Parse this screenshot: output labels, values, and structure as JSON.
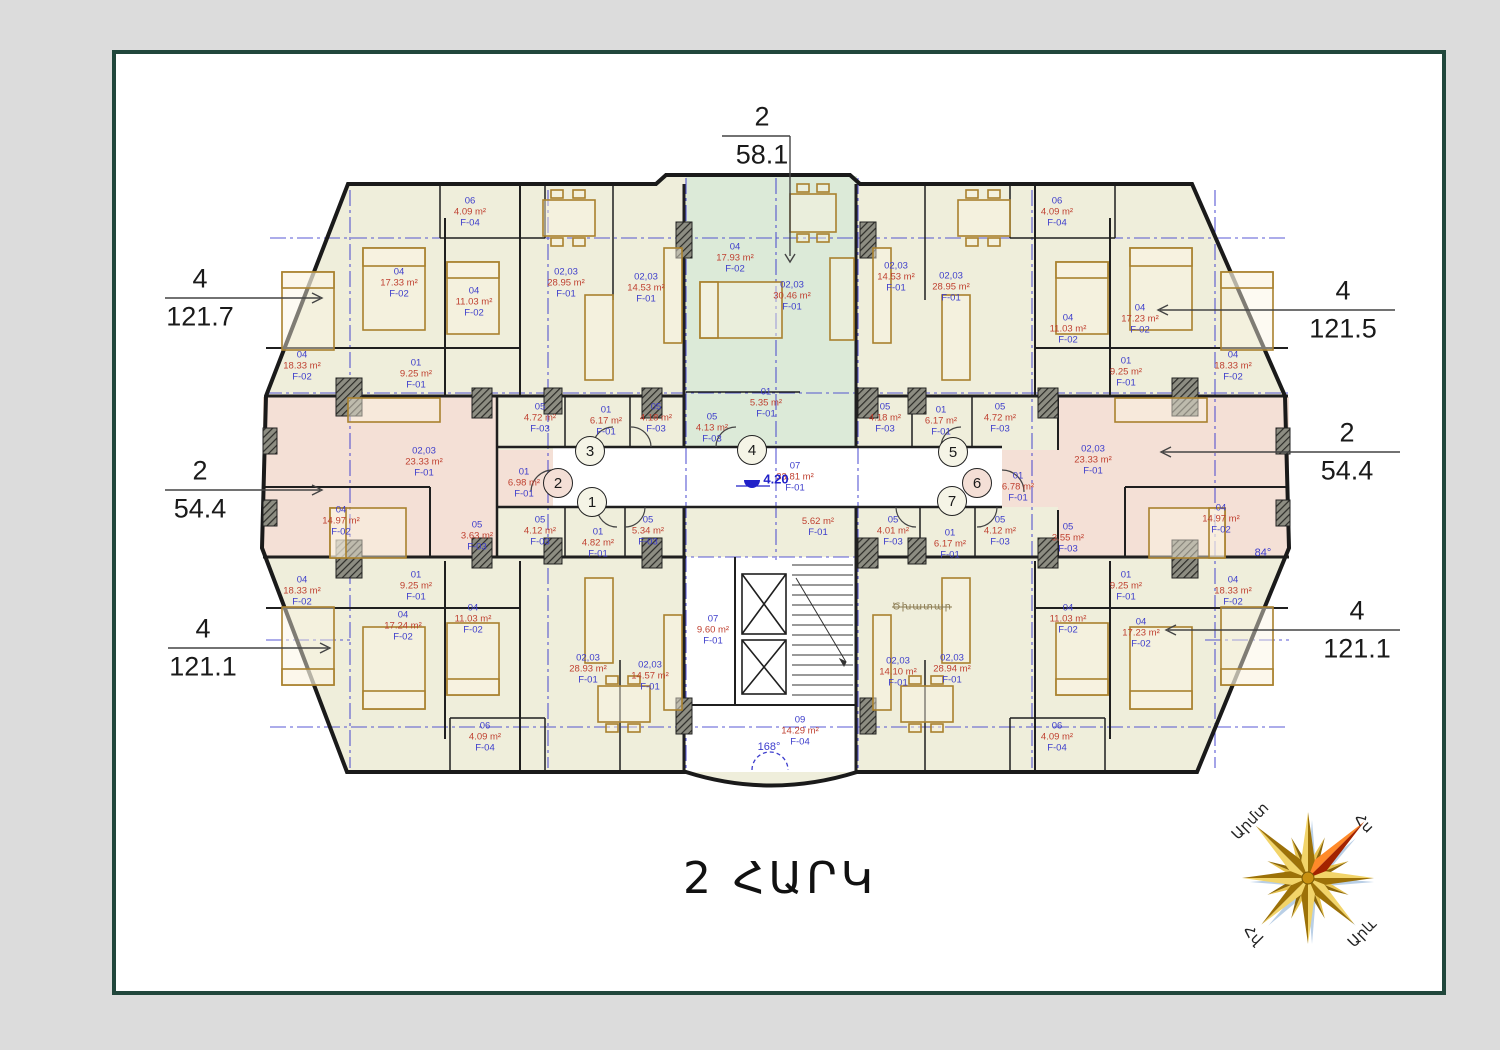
{
  "sheet": {
    "title": "2 ՀԱՐԿ"
  },
  "colors": {
    "canvas_bg": "#dcdcdc",
    "frame_border": "#21473c",
    "apartment_yellow": "#efeedb",
    "apartment_green": "#dcead8",
    "apartment_pink": "#f4e0d6",
    "wall": "#1a1a1a",
    "axis_blue": "#3c3ccd",
    "label_blue": "#3d3dcb",
    "label_red": "#bf4030",
    "furniture_brown": "#a9812e",
    "compass_gold": "#c89010",
    "compass_red": "#a32300"
  },
  "plan": {
    "rooms": [
      {
        "n": "06",
        "a": "4.09 m²",
        "c": "F-04",
        "x": 470,
        "y": 212
      },
      {
        "n": "04",
        "a": "17.33 m²",
        "c": "F-02",
        "x": 399,
        "y": 283
      },
      {
        "n": "04",
        "a": "11.03 m²",
        "c": "F-02",
        "x": 474,
        "y": 302
      },
      {
        "n": "02,03",
        "a": "28.95 m²",
        "c": "F-01",
        "x": 566,
        "y": 283
      },
      {
        "n": "02,03",
        "a": "14.53 m²",
        "c": "F-01",
        "x": 646,
        "y": 288
      },
      {
        "n": "01",
        "a": "9.25 m²",
        "c": "F-01",
        "x": 416,
        "y": 374
      },
      {
        "n": "04",
        "a": "18.33 m²",
        "c": "F-02",
        "x": 302,
        "y": 366
      },
      {
        "n": "04",
        "a": "17.93 m²",
        "c": "F-02",
        "x": 735,
        "y": 258
      },
      {
        "n": "02,03",
        "a": "30.46 m²",
        "c": "F-01",
        "x": 792,
        "y": 296
      },
      {
        "n": "01",
        "a": "5.35 m²",
        "c": "F-01",
        "x": 766,
        "y": 403
      },
      {
        "n": "06",
        "a": "4.09 m²",
        "c": "F-04",
        "x": 1057,
        "y": 212
      },
      {
        "n": "02,03",
        "a": "14.53 m²",
        "c": "F-01",
        "x": 896,
        "y": 277
      },
      {
        "n": "02,03",
        "a": "28.95 m²",
        "c": "F-01",
        "x": 951,
        "y": 287
      },
      {
        "n": "04",
        "a": "11.03 m²",
        "c": "F-02",
        "x": 1068,
        "y": 329
      },
      {
        "n": "04",
        "a": "17.23 m²",
        "c": "F-02",
        "x": 1140,
        "y": 319
      },
      {
        "n": "01",
        "a": "9.25 m²",
        "c": "F-01",
        "x": 1126,
        "y": 372
      },
      {
        "n": "04",
        "a": "18.33 m²",
        "c": "F-02",
        "x": 1233,
        "y": 366
      },
      {
        "n": "05",
        "a": "4.72 m²",
        "c": "F-03",
        "x": 540,
        "y": 418
      },
      {
        "n": "01",
        "a": "6.17 m²",
        "c": "F-01",
        "x": 606,
        "y": 421
      },
      {
        "n": "05",
        "a": "4.18 m²",
        "c": "F-03",
        "x": 656,
        "y": 418
      },
      {
        "n": "05",
        "a": "4.13 m²",
        "c": "F-03",
        "x": 712,
        "y": 428
      },
      {
        "n": "05",
        "a": "4.12 m²",
        "c": "F-03",
        "x": 540,
        "y": 531
      },
      {
        "n": "01",
        "a": "4.82 m²",
        "c": "F-01",
        "x": 598,
        "y": 543
      },
      {
        "n": "05",
        "a": "5.34 m²",
        "c": "F-03",
        "x": 648,
        "y": 531
      },
      {
        "n": "02,03",
        "a": "23.33 m²",
        "c": "F-01",
        "x": 424,
        "y": 462
      },
      {
        "n": "01",
        "a": "6.98 m²",
        "c": "F-01",
        "x": 524,
        "y": 483
      },
      {
        "n": "04",
        "a": "14.97 m²",
        "c": "F-02",
        "x": 341,
        "y": 521
      },
      {
        "n": "05",
        "a": "3.63 m²",
        "c": "F-03",
        "x": 477,
        "y": 536
      },
      {
        "n": "02,03",
        "a": "23.33 m²",
        "c": "F-01",
        "x": 1093,
        "y": 460
      },
      {
        "n": "01",
        "a": "6.78 m²",
        "c": "F-01",
        "x": 1018,
        "y": 487
      },
      {
        "n": "04",
        "a": "14.97 m²",
        "c": "F-02",
        "x": 1221,
        "y": 519
      },
      {
        "n": "05",
        "a": "3.55 m²",
        "c": "F-03",
        "x": 1068,
        "y": 538
      },
      {
        "n": "05",
        "a": "4.18 m²",
        "c": "F-03",
        "x": 885,
        "y": 418
      },
      {
        "n": "01",
        "a": "6.17 m²",
        "c": "F-01",
        "x": 941,
        "y": 421
      },
      {
        "n": "05",
        "a": "4.72 m²",
        "c": "F-03",
        "x": 1000,
        "y": 418
      },
      {
        "n": "05",
        "a": "4.01 m²",
        "c": "F-03",
        "x": 893,
        "y": 531
      },
      {
        "n": "01",
        "a": "6.17 m²",
        "c": "F-01",
        "x": 950,
        "y": 544
      },
      {
        "n": "05",
        "a": "4.12 m²",
        "c": "F-03",
        "x": 1000,
        "y": 531
      },
      {
        "n": "07",
        "a": "33.81 m²",
        "c": "F-01",
        "x": 795,
        "y": 477
      },
      {
        "a": "5.62 m²",
        "c": "F-01",
        "x": 818,
        "y": 527
      },
      {
        "n": "07",
        "a": "9.60 m²",
        "c": "F-01",
        "x": 713,
        "y": 630
      },
      {
        "n": "09",
        "a": "14.29 m²",
        "c": "F-04",
        "x": 800,
        "y": 731
      },
      {
        "n": "01",
        "a": "9.25 m²",
        "c": "F-01",
        "x": 416,
        "y": 586
      },
      {
        "n": "04",
        "a": "18.33 m²",
        "c": "F-02",
        "x": 302,
        "y": 591
      },
      {
        "n": "04",
        "a": "17.24 m²",
        "c": "F-02",
        "x": 403,
        "y": 626
      },
      {
        "n": "04",
        "a": "11.03 m²",
        "c": "F-02",
        "x": 473,
        "y": 619
      },
      {
        "n": "02,03",
        "a": "28.93 m²",
        "c": "F-01",
        "x": 588,
        "y": 669
      },
      {
        "n": "02,03",
        "a": "14.57 m²",
        "c": "F-01",
        "x": 650,
        "y": 676
      },
      {
        "n": "06",
        "a": "4.09 m²",
        "c": "F-04",
        "x": 485,
        "y": 737
      },
      {
        "n": "01",
        "a": "9.25 m²",
        "c": "F-01",
        "x": 1126,
        "y": 586
      },
      {
        "n": "04",
        "a": "18.33 m²",
        "c": "F-02",
        "x": 1233,
        "y": 591
      },
      {
        "n": "04",
        "a": "17.23 m²",
        "c": "F-02",
        "x": 1141,
        "y": 633
      },
      {
        "n": "04",
        "a": "11.03 m²",
        "c": "F-02",
        "x": 1068,
        "y": 619
      },
      {
        "n": "02,03",
        "a": "28.94 m²",
        "c": "F-01",
        "x": 952,
        "y": 669
      },
      {
        "n": "02,03",
        "a": "14.10 m²",
        "c": "F-01",
        "x": 898,
        "y": 672
      },
      {
        "n": "06",
        "a": "4.09 m²",
        "c": "F-04",
        "x": 1057,
        "y": 737
      }
    ],
    "bubbles": [
      {
        "t": "1",
        "x": 592,
        "y": 502,
        "f": "#f5f4e6"
      },
      {
        "t": "2",
        "x": 558,
        "y": 483,
        "f": "#f4dfd6"
      },
      {
        "t": "3",
        "x": 590,
        "y": 451,
        "f": "#f5f4e6"
      },
      {
        "t": "4",
        "x": 752,
        "y": 450,
        "f": "#f5f4e6"
      },
      {
        "t": "5",
        "x": 953,
        "y": 452,
        "f": "#f5f4e6"
      },
      {
        "t": "6",
        "x": 977,
        "y": 483,
        "f": "#f4dfd6"
      },
      {
        "t": "7",
        "x": 952,
        "y": 501,
        "f": "#f5f4e6"
      }
    ],
    "dimensions": [
      {
        "num": "2",
        "value": "58.1",
        "x": 762,
        "y": 136
      },
      {
        "num": "4",
        "value": "121.7",
        "x": 200,
        "y": 298
      },
      {
        "num": "2",
        "value": "54.4",
        "x": 200,
        "y": 490
      },
      {
        "num": "4",
        "value": "121.1",
        "x": 203,
        "y": 648
      },
      {
        "num": "4",
        "value": "121.5",
        "x": 1343,
        "y": 310
      },
      {
        "num": "2",
        "value": "54.4",
        "x": 1347,
        "y": 452
      },
      {
        "num": "4",
        "value": "121.1",
        "x": 1357,
        "y": 630
      }
    ],
    "annotations": [
      {
        "t": "4.20",
        "x": 776,
        "y": 479,
        "cls": "elev"
      },
      {
        "t": "168°",
        "x": 769,
        "y": 747,
        "cls": "angle"
      },
      {
        "t": "84°",
        "x": 1263,
        "y": 553,
        "cls": "angle"
      },
      {
        "t": "Ծխատար",
        "x": 922,
        "y": 607,
        "cls": "note"
      }
    ]
  },
  "compass": {
    "labels": [
      {
        "t": "Արմտ",
        "x": 1250,
        "y": 821,
        "r": -45
      },
      {
        "t": "Հս",
        "x": 1364,
        "y": 823,
        "r": 45
      },
      {
        "t": "Հվ",
        "x": 1253,
        "y": 935,
        "r": 45
      },
      {
        "t": "Արև",
        "x": 1362,
        "y": 933,
        "r": -45
      }
    ]
  }
}
